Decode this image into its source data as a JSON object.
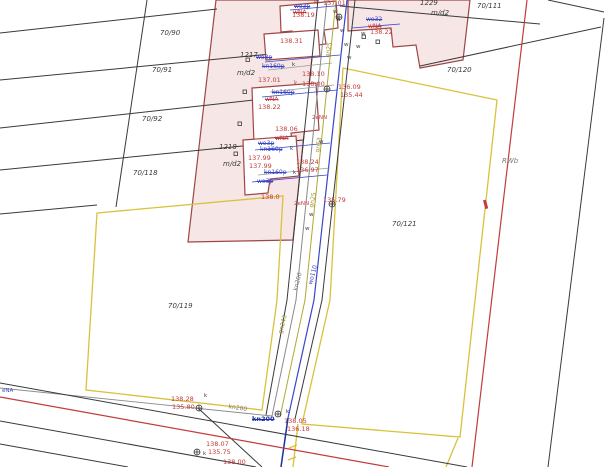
{
  "map": {
    "kind": "cadastral-survey-base-map",
    "parcel_numbers": [
      "70/90",
      "70/91",
      "70/92",
      "70/118",
      "70/119",
      "70/120",
      "70/121",
      "70/111"
    ],
    "building_numbers": [
      "1217",
      "1218",
      "1229"
    ],
    "building_use_code": "m/d2",
    "area_code": "RWb",
    "utility_line_codes": [
      "kn200",
      "wo110",
      "gn243",
      "gn63",
      "gn25"
    ],
    "crossed_out_utility_codes": [
      "wo3p",
      "wo32",
      "kn160p",
      "wNA",
      "kn200"
    ],
    "point_marks": [
      "k",
      "w",
      "eNA",
      "2eNN"
    ]
  },
  "colors": {
    "background": "#ffffff",
    "parcel_line": "#3a3a3a",
    "building_fill": "#f6e6e6",
    "building_stroke": "#a04545",
    "boundary_yellow": "#d8c23c",
    "power_red": "#c23c3c",
    "water_blue": "#3946c8",
    "sewer_gray": "#8a8a8a",
    "gas_olive": "#b0a835",
    "projected_navy": "#1b2f9e",
    "elevation_text": "#c43a3a"
  },
  "labels": [
    {
      "t": "70/90",
      "x": 160,
      "y": 30,
      "cls": "black italic",
      "fs": 7,
      "n": "parcel-70-90"
    },
    {
      "t": "70/91",
      "x": 152,
      "y": 67,
      "cls": "black italic",
      "fs": 7,
      "n": "parcel-70-91"
    },
    {
      "t": "70/92",
      "x": 142,
      "y": 116,
      "cls": "black italic",
      "fs": 7,
      "n": "parcel-70-92"
    },
    {
      "t": "70/118",
      "x": 133,
      "y": 170,
      "cls": "black italic",
      "fs": 7,
      "n": "parcel-70-118"
    },
    {
      "t": "70/119",
      "x": 168,
      "y": 303,
      "cls": "black italic",
      "fs": 7,
      "n": "parcel-70-119"
    },
    {
      "t": "70/120",
      "x": 447,
      "y": 67,
      "cls": "black italic",
      "fs": 7,
      "n": "parcel-70-120"
    },
    {
      "t": "70/121",
      "x": 392,
      "y": 221,
      "cls": "black italic",
      "fs": 7,
      "n": "parcel-70-121"
    },
    {
      "t": "70/111",
      "x": 477,
      "y": 3,
      "cls": "black italic",
      "fs": 7,
      "n": "parcel-70-111"
    },
    {
      "t": "1217",
      "x": 240,
      "y": 52,
      "cls": "black italic",
      "fs": 7,
      "n": "building-1217"
    },
    {
      "t": "m/d2",
      "x": 237,
      "y": 70,
      "cls": "black italic",
      "fs": 7,
      "n": "building-use-code"
    },
    {
      "t": "1218",
      "x": 219,
      "y": 144,
      "cls": "black italic",
      "fs": 7,
      "n": "building-1218"
    },
    {
      "t": "m/d2",
      "x": 223,
      "y": 161,
      "cls": "black italic",
      "fs": 7,
      "n": "building-use-code"
    },
    {
      "t": "1229",
      "x": 420,
      "y": 0,
      "cls": "black italic",
      "fs": 7,
      "n": "building-1229"
    },
    {
      "t": "m/d2",
      "x": 431,
      "y": 10,
      "cls": "black italic",
      "fs": 7,
      "n": "building-use-code"
    },
    {
      "t": "RWb",
      "x": 502,
      "y": 158,
      "cls": "gray italic",
      "fs": 7,
      "n": "area-code-rwb"
    },
    {
      "t": "k",
      "x": 314,
      "y": 0,
      "cls": "red",
      "fs": 6,
      "n": "manhole-mark"
    },
    {
      "t": "137.01",
      "x": 323,
      "y": 0,
      "cls": "red",
      "fs": 6.5,
      "n": "elevation"
    },
    {
      "t": "138.19",
      "x": 292,
      "y": 12,
      "cls": "red",
      "fs": 6.5,
      "n": "elevation"
    },
    {
      "t": "138.31",
      "x": 280,
      "y": 38,
      "cls": "red",
      "fs": 6.5,
      "n": "elevation"
    },
    {
      "t": "138.22",
      "x": 370,
      "y": 29,
      "cls": "red",
      "fs": 6.5,
      "n": "elevation"
    },
    {
      "t": "137.01",
      "x": 258,
      "y": 77,
      "cls": "red",
      "fs": 6.5,
      "n": "elevation"
    },
    {
      "t": "138.10",
      "x": 302,
      "y": 71,
      "cls": "red",
      "fs": 6.5,
      "n": "elevation"
    },
    {
      "t": "k",
      "x": 294,
      "y": 81,
      "cls": "red",
      "fs": 6,
      "n": "manhole-mark"
    },
    {
      "t": "138.00",
      "x": 302,
      "y": 81,
      "cls": "red",
      "fs": 6.5,
      "n": "elevation"
    },
    {
      "t": "136.09",
      "x": 338,
      "y": 84,
      "cls": "red",
      "fs": 6.5,
      "n": "elevation"
    },
    {
      "t": "135.44",
      "x": 340,
      "y": 92,
      "cls": "red",
      "fs": 6.5,
      "n": "elevation"
    },
    {
      "t": "138.22",
      "x": 258,
      "y": 104,
      "cls": "red",
      "fs": 6.5,
      "n": "elevation"
    },
    {
      "t": "138.06",
      "x": 275,
      "y": 126,
      "cls": "red",
      "fs": 6.5,
      "n": "elevation"
    },
    {
      "t": "137.99",
      "x": 248,
      "y": 155,
      "cls": "red",
      "fs": 6.5,
      "n": "elevation"
    },
    {
      "t": "137.99",
      "x": 249,
      "y": 163,
      "cls": "red",
      "fs": 6.5,
      "n": "elevation"
    },
    {
      "t": "138.24",
      "x": 296,
      "y": 159,
      "cls": "red",
      "fs": 6.5,
      "n": "elevation"
    },
    {
      "t": "136.97",
      "x": 296,
      "y": 167,
      "cls": "red",
      "fs": 6.5,
      "n": "elevation"
    },
    {
      "t": "138.0",
      "x": 261,
      "y": 194,
      "cls": "red",
      "fs": 6.5,
      "n": "elevation"
    },
    {
      "t": "2eNN",
      "x": 312,
      "y": 116,
      "cls": "red",
      "fs": 5.5,
      "n": "cable-label"
    },
    {
      "t": "2eNN",
      "x": 294,
      "y": 202,
      "cls": "red",
      "fs": 5.5,
      "n": "cable-label"
    },
    {
      "t": "135.79",
      "x": 323,
      "y": 197,
      "cls": "red",
      "fs": 6.5,
      "n": "elevation"
    },
    {
      "t": "138.28",
      "x": 171,
      "y": 396,
      "cls": "red",
      "fs": 6.5,
      "n": "elevation"
    },
    {
      "t": "135.80",
      "x": 172,
      "y": 404,
      "cls": "red",
      "fs": 6.5,
      "n": "elevation"
    },
    {
      "t": "138.05",
      "x": 284,
      "y": 418,
      "cls": "red",
      "fs": 6.5,
      "n": "elevation"
    },
    {
      "t": "136.18",
      "x": 287,
      "y": 426,
      "cls": "red",
      "fs": 6.5,
      "n": "elevation"
    },
    {
      "t": "138.07",
      "x": 206,
      "y": 441,
      "cls": "red",
      "fs": 6.5,
      "n": "elevation"
    },
    {
      "t": "135.75",
      "x": 208,
      "y": 449,
      "cls": "red",
      "fs": 6.5,
      "n": "elevation"
    },
    {
      "t": "138.00",
      "x": 223,
      "y": 459,
      "cls": "red",
      "fs": 6.5,
      "n": "elevation"
    },
    {
      "t": "wNA",
      "x": 293,
      "y": 10,
      "cls": "red strike",
      "fs": 6,
      "n": "crossed-utility"
    },
    {
      "t": "wNA",
      "x": 368,
      "y": 24,
      "cls": "red strike",
      "fs": 6,
      "n": "crossed-utility"
    },
    {
      "t": "wNA",
      "x": 265,
      "y": 97,
      "cls": "red strike",
      "fs": 6,
      "n": "crossed-utility"
    },
    {
      "t": "wNA",
      "x": 275,
      "y": 136,
      "cls": "red strike",
      "fs": 6,
      "n": "crossed-utility"
    },
    {
      "t": "wo3p",
      "x": 294,
      "y": 4,
      "cls": "blue strike",
      "fs": 6,
      "n": "crossed-utility"
    },
    {
      "t": "wo32",
      "x": 366,
      "y": 17,
      "cls": "blue strike",
      "fs": 6,
      "n": "crossed-utility"
    },
    {
      "t": "wo3p",
      "x": 256,
      "y": 55,
      "cls": "blue strike",
      "fs": 6,
      "n": "crossed-utility"
    },
    {
      "t": "kn160p",
      "x": 262,
      "y": 64,
      "cls": "blue strike",
      "fs": 6,
      "n": "crossed-utility"
    },
    {
      "t": "kn160p",
      "x": 272,
      "y": 90,
      "cls": "blue strike",
      "fs": 6,
      "n": "crossed-utility"
    },
    {
      "t": "wo3p",
      "x": 258,
      "y": 141,
      "cls": "blue strike",
      "fs": 6,
      "n": "crossed-utility"
    },
    {
      "t": "kn160p",
      "x": 260,
      "y": 147,
      "cls": "blue strike",
      "fs": 6,
      "n": "crossed-utility"
    },
    {
      "t": "kn160p",
      "x": 264,
      "y": 170,
      "cls": "blue strike",
      "fs": 6,
      "n": "crossed-utility"
    },
    {
      "t": "wo3p",
      "x": 257,
      "y": 179,
      "cls": "blue strike",
      "fs": 6,
      "n": "crossed-utility"
    },
    {
      "t": "kn200",
      "x": 252,
      "y": 416,
      "cls": "navy strike",
      "fs": 6.5,
      "n": "crossed-utility"
    },
    {
      "t": "eNA",
      "x": 2,
      "y": 389,
      "cls": "blue",
      "fs": 5.5,
      "n": "cable-label"
    },
    {
      "t": "kn200",
      "x": 293,
      "y": 290,
      "cls": "gray",
      "fs": 6,
      "r": -75,
      "n": "sewer-line-label"
    },
    {
      "t": "wo110",
      "x": 308,
      "y": 284,
      "cls": "blue",
      "fs": 6,
      "r": -75,
      "n": "water-line-label"
    },
    {
      "t": "gn243",
      "x": 278,
      "y": 333,
      "cls": "olive",
      "fs": 6,
      "r": -75,
      "n": "gas-line-label"
    },
    {
      "t": "kn200",
      "x": 229,
      "y": 404,
      "cls": "gray",
      "fs": 6,
      "r": 10,
      "n": "sewer-line-label"
    },
    {
      "t": "gn63",
      "x": 315,
      "y": 152,
      "cls": "olive",
      "fs": 6,
      "r": -80,
      "n": "gas-line-label"
    },
    {
      "t": "gn25",
      "x": 325,
      "y": 57,
      "cls": "olive",
      "fs": 6,
      "r": -80,
      "n": "gas-line-label"
    },
    {
      "t": "gn25",
      "x": 309,
      "y": 207,
      "cls": "olive",
      "fs": 6,
      "r": -78,
      "n": "gas-line-label"
    },
    {
      "t": "w",
      "x": 333,
      "y": 10,
      "cls": "black",
      "fs": 5.5,
      "n": "valve-mark"
    },
    {
      "t": "w",
      "x": 336,
      "y": 18,
      "cls": "black",
      "fs": 5.5,
      "n": "valve-mark"
    },
    {
      "t": "w",
      "x": 340,
      "y": 29,
      "cls": "black",
      "fs": 5.5,
      "n": "valve-mark"
    },
    {
      "t": "w",
      "x": 344,
      "y": 43,
      "cls": "black",
      "fs": 5.5,
      "n": "valve-mark"
    },
    {
      "t": "w",
      "x": 347,
      "y": 56,
      "cls": "black",
      "fs": 5.5,
      "n": "valve-mark"
    },
    {
      "t": "w",
      "x": 319,
      "y": 140,
      "cls": "black",
      "fs": 5.5,
      "n": "valve-mark"
    },
    {
      "t": "w",
      "x": 309,
      "y": 213,
      "cls": "black",
      "fs": 5.5,
      "n": "valve-mark"
    },
    {
      "t": "w",
      "x": 305,
      "y": 227,
      "cls": "black",
      "fs": 5.5,
      "n": "valve-mark"
    },
    {
      "t": "w",
      "x": 361,
      "y": 32,
      "cls": "black",
      "fs": 5.5,
      "n": "valve-mark"
    },
    {
      "t": "w",
      "x": 356,
      "y": 45,
      "cls": "black",
      "fs": 5.5,
      "n": "valve-mark"
    },
    {
      "t": "k",
      "x": 204,
      "y": 394,
      "cls": "black",
      "fs": 5.5,
      "n": "manhole-mark"
    },
    {
      "t": "k",
      "x": 203,
      "y": 452,
      "cls": "black",
      "fs": 5.5,
      "n": "manhole-mark"
    },
    {
      "t": "k",
      "x": 286,
      "y": 410,
      "cls": "black",
      "fs": 5.5,
      "n": "manhole-mark"
    },
    {
      "t": "k",
      "x": 292,
      "y": 63,
      "cls": "black",
      "fs": 5.5,
      "n": "manhole-mark"
    },
    {
      "t": "k",
      "x": 290,
      "y": 147,
      "cls": "black",
      "fs": 5.5,
      "n": "manhole-mark"
    },
    {
      "t": "k",
      "x": 293,
      "y": 171,
      "cls": "black",
      "fs": 5.5,
      "n": "manhole-mark"
    }
  ]
}
